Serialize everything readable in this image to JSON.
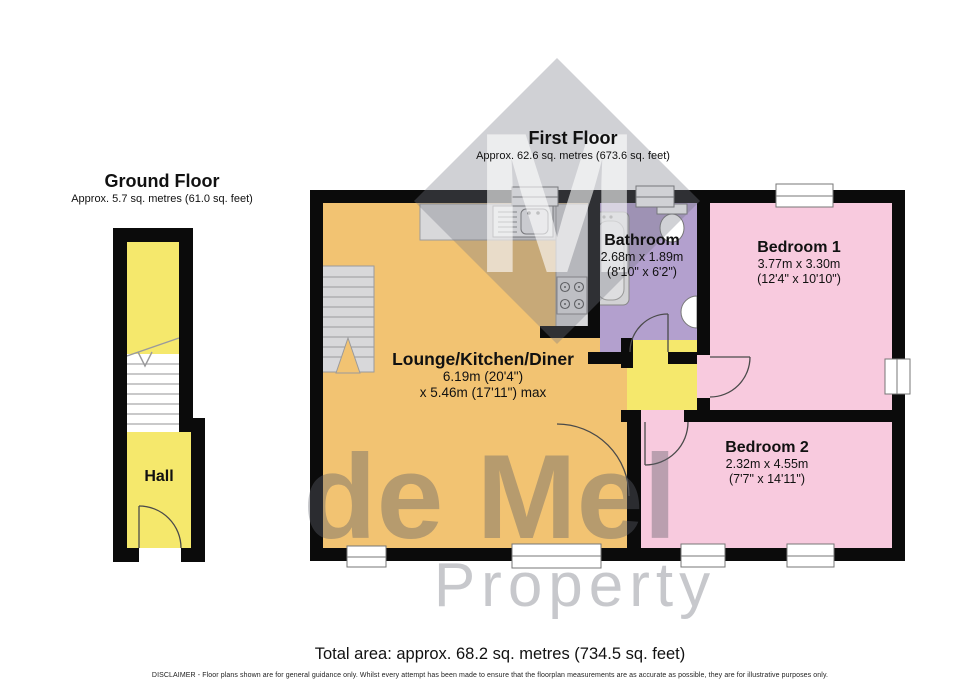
{
  "ground_floor": {
    "title": "Ground Floor",
    "subtitle": "Approx. 5.7 sq. metres (61.0 sq. feet)",
    "rooms": {
      "hall": {
        "name": "Hall"
      }
    }
  },
  "first_floor": {
    "title": "First Floor",
    "subtitle": "Approx. 62.6 sq. metres (673.6 sq. feet)",
    "rooms": {
      "lounge": {
        "name": "Lounge/Kitchen/Diner",
        "dim1": "6.19m (20'4\")",
        "dim2": "x 5.46m (17'11\") max"
      },
      "bathroom": {
        "name": "Bathroom",
        "dim1": "2.68m x 1.89m",
        "dim2": "(8'10\" x 6'2\")"
      },
      "bedroom1": {
        "name": "Bedroom 1",
        "dim1": "3.77m x 3.30m",
        "dim2": "(12'4\" x 10'10\")"
      },
      "bedroom2": {
        "name": "Bedroom 2",
        "dim1": "2.32m x 4.55m",
        "dim2": "(7'7\" x 14'11\")"
      }
    }
  },
  "watermark": {
    "monogram": "M",
    "line1": "de Mel",
    "line2": "Property"
  },
  "footer": {
    "total_area": "Total area: approx. 68.2 sq. metres (734.5 sq. feet)",
    "disclaimer": "DISCLAIMER -  Floor plans shown are for general guidance only. Whilst every attempt has been made to ensure that the floorplan measurements are as accurate as possible, they are for illustrative purposes only."
  },
  "colors": {
    "wall": "#0b0b0b",
    "lounge": "#f2c372",
    "bedroom": "#f8cade",
    "bathroom": "#b3a0ce",
    "hall": "#f5e86c",
    "fixture": "#d8d8da",
    "fixture_dark": "#9b9b9d"
  }
}
